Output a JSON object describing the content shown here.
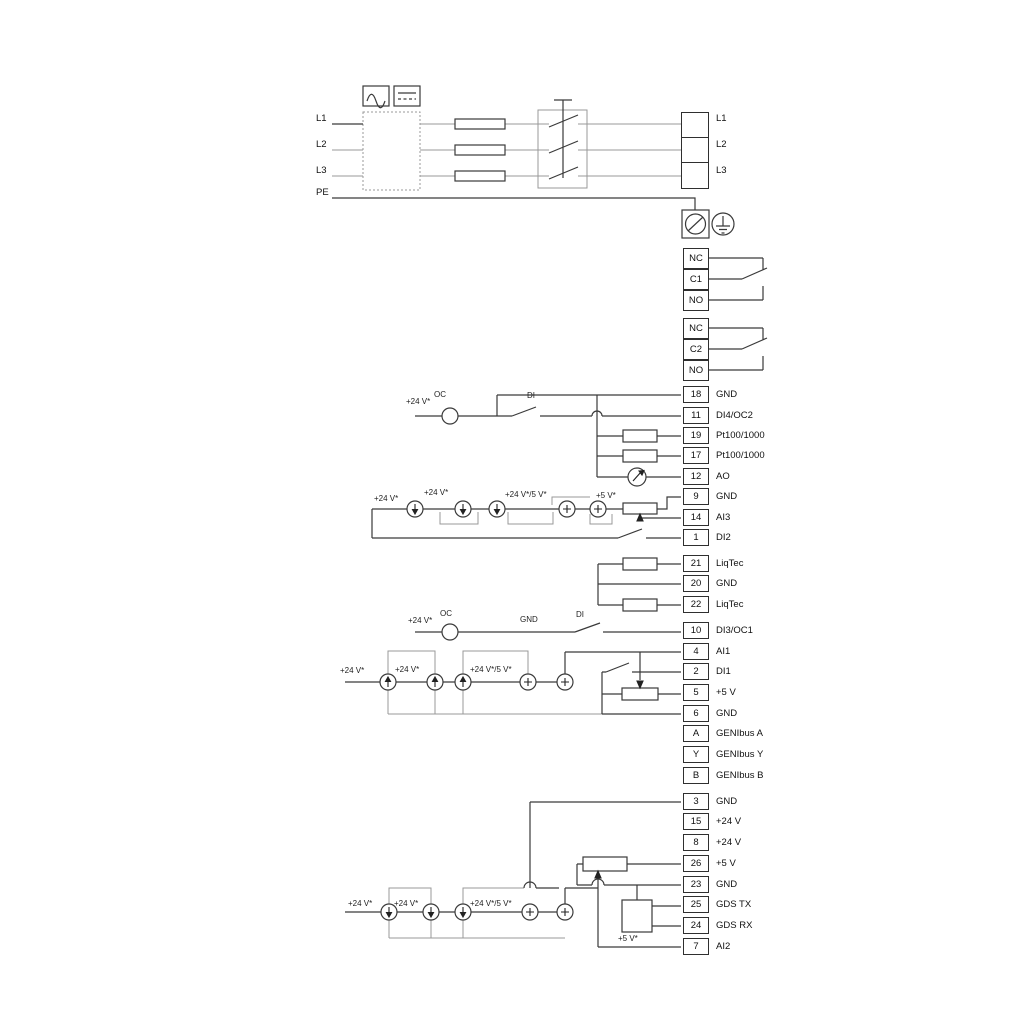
{
  "power": {
    "left": [
      "L1",
      "L2",
      "L3",
      "PE"
    ],
    "right": [
      "L1",
      "L2",
      "L3"
    ]
  },
  "relay1": [
    "NC",
    "C1",
    "NO"
  ],
  "relay2": [
    "NC",
    "C2",
    "NO"
  ],
  "terminals": {
    "io1": [
      {
        "num": "18",
        "label": "GND"
      },
      {
        "num": "11",
        "label": "DI4/OC2"
      },
      {
        "num": "19",
        "label": "Pt100/1000"
      },
      {
        "num": "17",
        "label": "Pt100/1000"
      },
      {
        "num": "12",
        "label": "AO"
      },
      {
        "num": "9",
        "label": "GND"
      },
      {
        "num": "14",
        "label": "AI3"
      },
      {
        "num": "1",
        "label": "DI2"
      }
    ],
    "liqtec": [
      {
        "num": "21",
        "label": "LiqTec"
      },
      {
        "num": "20",
        "label": "GND"
      },
      {
        "num": "22",
        "label": "LiqTec"
      }
    ],
    "io2": [
      {
        "num": "10",
        "label": "DI3/OC1"
      },
      {
        "num": "4",
        "label": "AI1"
      },
      {
        "num": "2",
        "label": "DI1"
      },
      {
        "num": "5",
        "label": "+5 V"
      },
      {
        "num": "6",
        "label": "GND"
      },
      {
        "num": "A",
        "label": "GENIbus A"
      },
      {
        "num": "Y",
        "label": "GENIbus Y"
      },
      {
        "num": "B",
        "label": "GENIbus B"
      }
    ],
    "io3": [
      {
        "num": "3",
        "label": "GND"
      },
      {
        "num": "15",
        "label": "+24 V"
      },
      {
        "num": "8",
        "label": "+24 V"
      },
      {
        "num": "26",
        "label": "+5 V"
      },
      {
        "num": "23",
        "label": "GND"
      },
      {
        "num": "25",
        "label": "GDS TX"
      },
      {
        "num": "24",
        "label": "GDS RX"
      },
      {
        "num": "7",
        "label": "AI2"
      }
    ]
  },
  "labels": {
    "floating": [
      {
        "text": "+24 V*"
      },
      {
        "text": "OC"
      },
      {
        "text": "DI"
      },
      {
        "text": "+24 V*"
      },
      {
        "text": "+24 V*"
      },
      {
        "text": "+24 V*/5 V*"
      },
      {
        "text": "+5 V*"
      },
      {
        "text": "+24 V*"
      },
      {
        "text": "OC"
      },
      {
        "text": "GND"
      },
      {
        "text": "DI"
      },
      {
        "text": "+24 V*"
      },
      {
        "text": "+24 V*"
      },
      {
        "text": "+24 V*/5 V*"
      },
      {
        "text": "+24 V*"
      },
      {
        "text": "+24 V*"
      },
      {
        "text": "+24 V*/5 V*"
      },
      {
        "text": "+5 V*"
      }
    ]
  },
  "colors": {
    "line_dark": "#3a3a3a",
    "line_gray": "#999999",
    "text": "#111111",
    "background": "#ffffff"
  }
}
